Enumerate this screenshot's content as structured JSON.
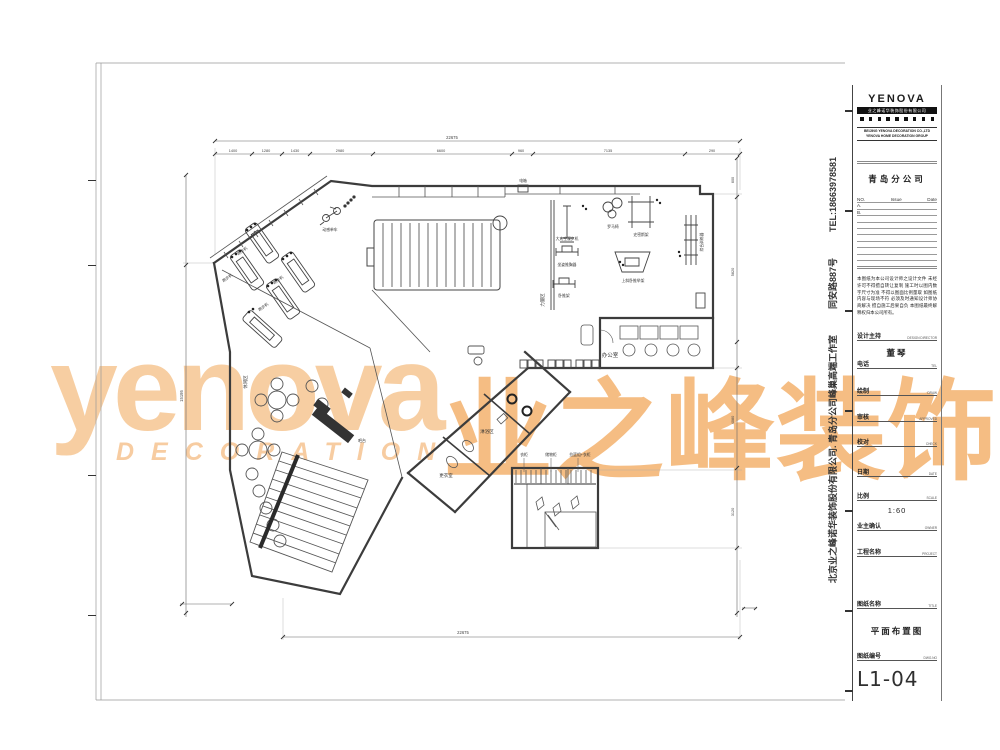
{
  "watermark": {
    "en": "yenova",
    "sub": "DECORATION",
    "cn": "业之峰装饰"
  },
  "sidebar": {
    "company": "北京业之峰诺华装饰股份有限公司. 青岛分公司峰巢高端工作室",
    "address": "同安路887号",
    "tel": "TEL:18663978581"
  },
  "titleblock": {
    "logo": {
      "brand": "YENOVA",
      "bar": "业之峰诺华装饰股份有限公司",
      "line1": "BEIJING YENOVA DECORATION CO.,LTD",
      "line2": "YENOVA HOME DECORATION GROUP"
    },
    "branch": "青岛分公司",
    "revisions": {
      "col_no": "NO.",
      "col_issue": "Issue",
      "col_date": "Date",
      "row_a": "A.",
      "row_b": "B."
    },
    "notes": "本图纸为本公司设计师之设计文件 未经许可不得擅自转让复制 施工时以图内数字尺寸为准 不得以图面比例量取 如图纸内容与现场不符 必须及时通知设计师协商解决 擅自施工后果自负 本图纸最终解释权归本公司所有。",
    "fields": [
      {
        "label": "设计主持",
        "cap": "DESIGN DIRECTOR"
      },
      {
        "label": "电话",
        "cap": "TEL"
      },
      {
        "label": "绘制",
        "cap": "DRAW"
      },
      {
        "label": "审核",
        "cap": "APPROVED"
      },
      {
        "label": "校对",
        "cap": "CHECK"
      },
      {
        "label": "日期",
        "cap": "DATE"
      },
      {
        "label": "比例",
        "cap": "SCALE"
      },
      {
        "label": "业主确认",
        "cap": "OWNER"
      },
      {
        "label": "工程名称",
        "cap": "PROJECT"
      },
      {
        "label": "图纸名称",
        "cap": "TITLE"
      },
      {
        "label": "图纸编号",
        "cap": "DWG.NO"
      }
    ],
    "designer_name": "董琴",
    "scale_value": "1:60",
    "drawing_title": "平面布置图",
    "drawing_no": "L1-04"
  },
  "plan": {
    "room_labels": {
      "office": "办公室",
      "shower": "淋浴区",
      "locker": "更衣室",
      "bar": "吧台",
      "lounge": "休闲区",
      "strength": "力量区"
    },
    "equipment_labels": {
      "treadmill": "跑步机",
      "bike": "动感单车",
      "spacewalker": "大太空漫步机",
      "chest_press": "坐姿推胸器",
      "bench": "卧推架",
      "roman_chair": "罗马椅",
      "smith": "史密斯架",
      "incline_bench": "上斜卧推举架",
      "trainer": "综合训练器",
      "power_box": "电箱"
    },
    "closet_labels": [
      "衣柜",
      "储物柜",
      "拉篮组+衣柜"
    ],
    "dimensions": {
      "top_total": "22675",
      "bottom_total": "22675",
      "left_total": "15195",
      "segments": [
        "1400",
        "1280",
        "1430",
        "2980",
        "6600",
        "960",
        "7135",
        "290"
      ],
      "right_segments": [
        "600",
        "5820",
        "4080",
        "3120"
      ]
    }
  }
}
